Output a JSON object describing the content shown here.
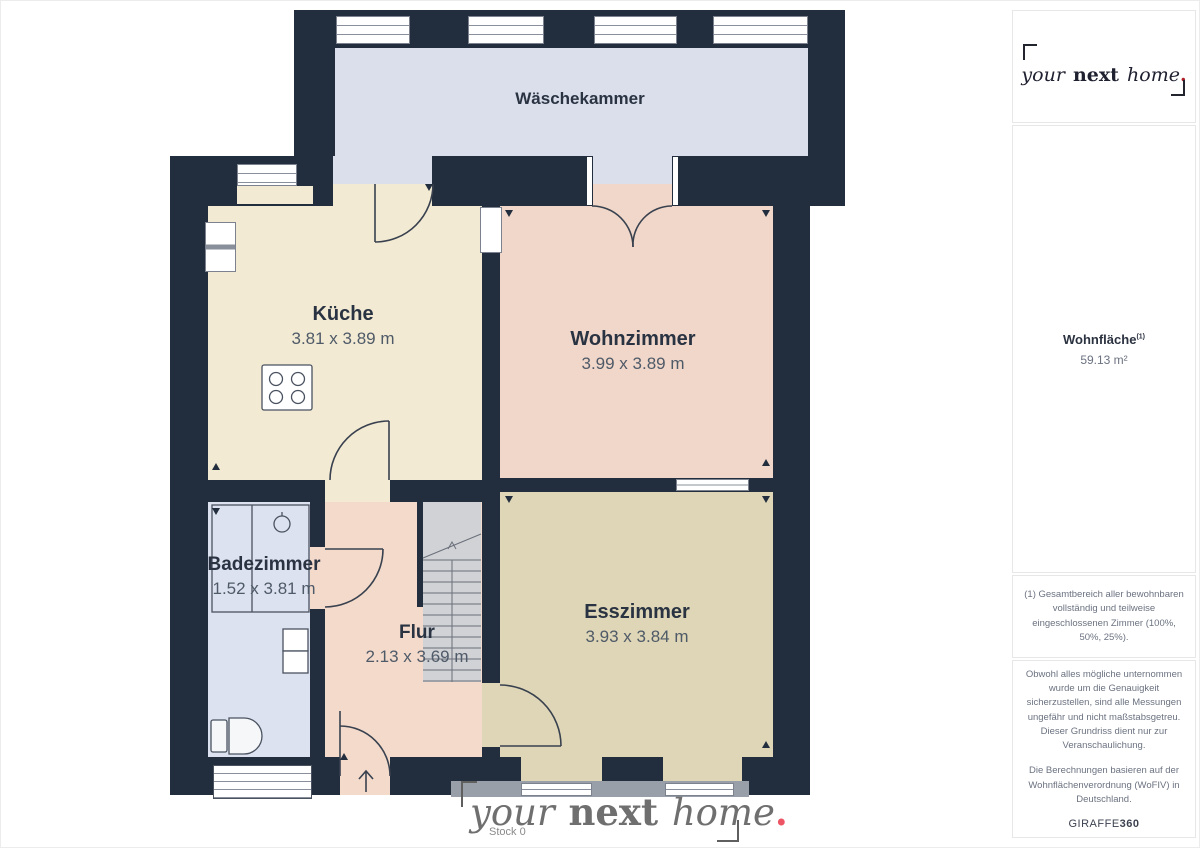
{
  "branding": {
    "word1": "your",
    "word2": "next",
    "word3": "home",
    "dot": ".",
    "dot_color_top": "#b01e28",
    "dot_color_bottom": "#ed5565"
  },
  "sidebar": {
    "area_label": "Wohnfläche",
    "area_sup": "(1)",
    "area_value": "59.13 m²",
    "footnote1": "(1) Gesamtbereich aller bewohnbaren vollständig und teilweise eingeschlossenen Zimmer (100%, 50%, 25%).",
    "disclaimer1": "Obwohl alles mögliche unternommen wurde um die Genauigkeit sicherzustellen, sind alle Messungen ungefähr und nicht maßstabsgetreu. Dieser Grundriss dient nur zur Veranschaulichung.",
    "disclaimer2": "Die Berechnungen basieren auf der Wohnflächenverordnung (WoFIV) in Deutschland.",
    "brand_plain": "GIRAFFE",
    "brand_bold": "360"
  },
  "floorplan": {
    "floor_label": "Stock 0",
    "wall_color": "#222d3d",
    "rooms": [
      {
        "name": "Wäschekammer",
        "dims": "",
        "color": "#dadfeb"
      },
      {
        "name": "Küche",
        "dims": "3.81 x 3.89 m",
        "color": "#f2ead3"
      },
      {
        "name": "Wohnzimmer",
        "dims": "3.99 x 3.89 m",
        "color": "#f0d7c9"
      },
      {
        "name": "Badezimmer",
        "dims": "1.52 x 3.81 m",
        "color": "#dde2f0"
      },
      {
        "name": "Flur",
        "dims": "2.13 x 3.69 m",
        "color": "#f3dacb"
      },
      {
        "name": "Esszimmer",
        "dims": "3.93 x 3.84 m",
        "color": "#ded6b6"
      }
    ]
  }
}
